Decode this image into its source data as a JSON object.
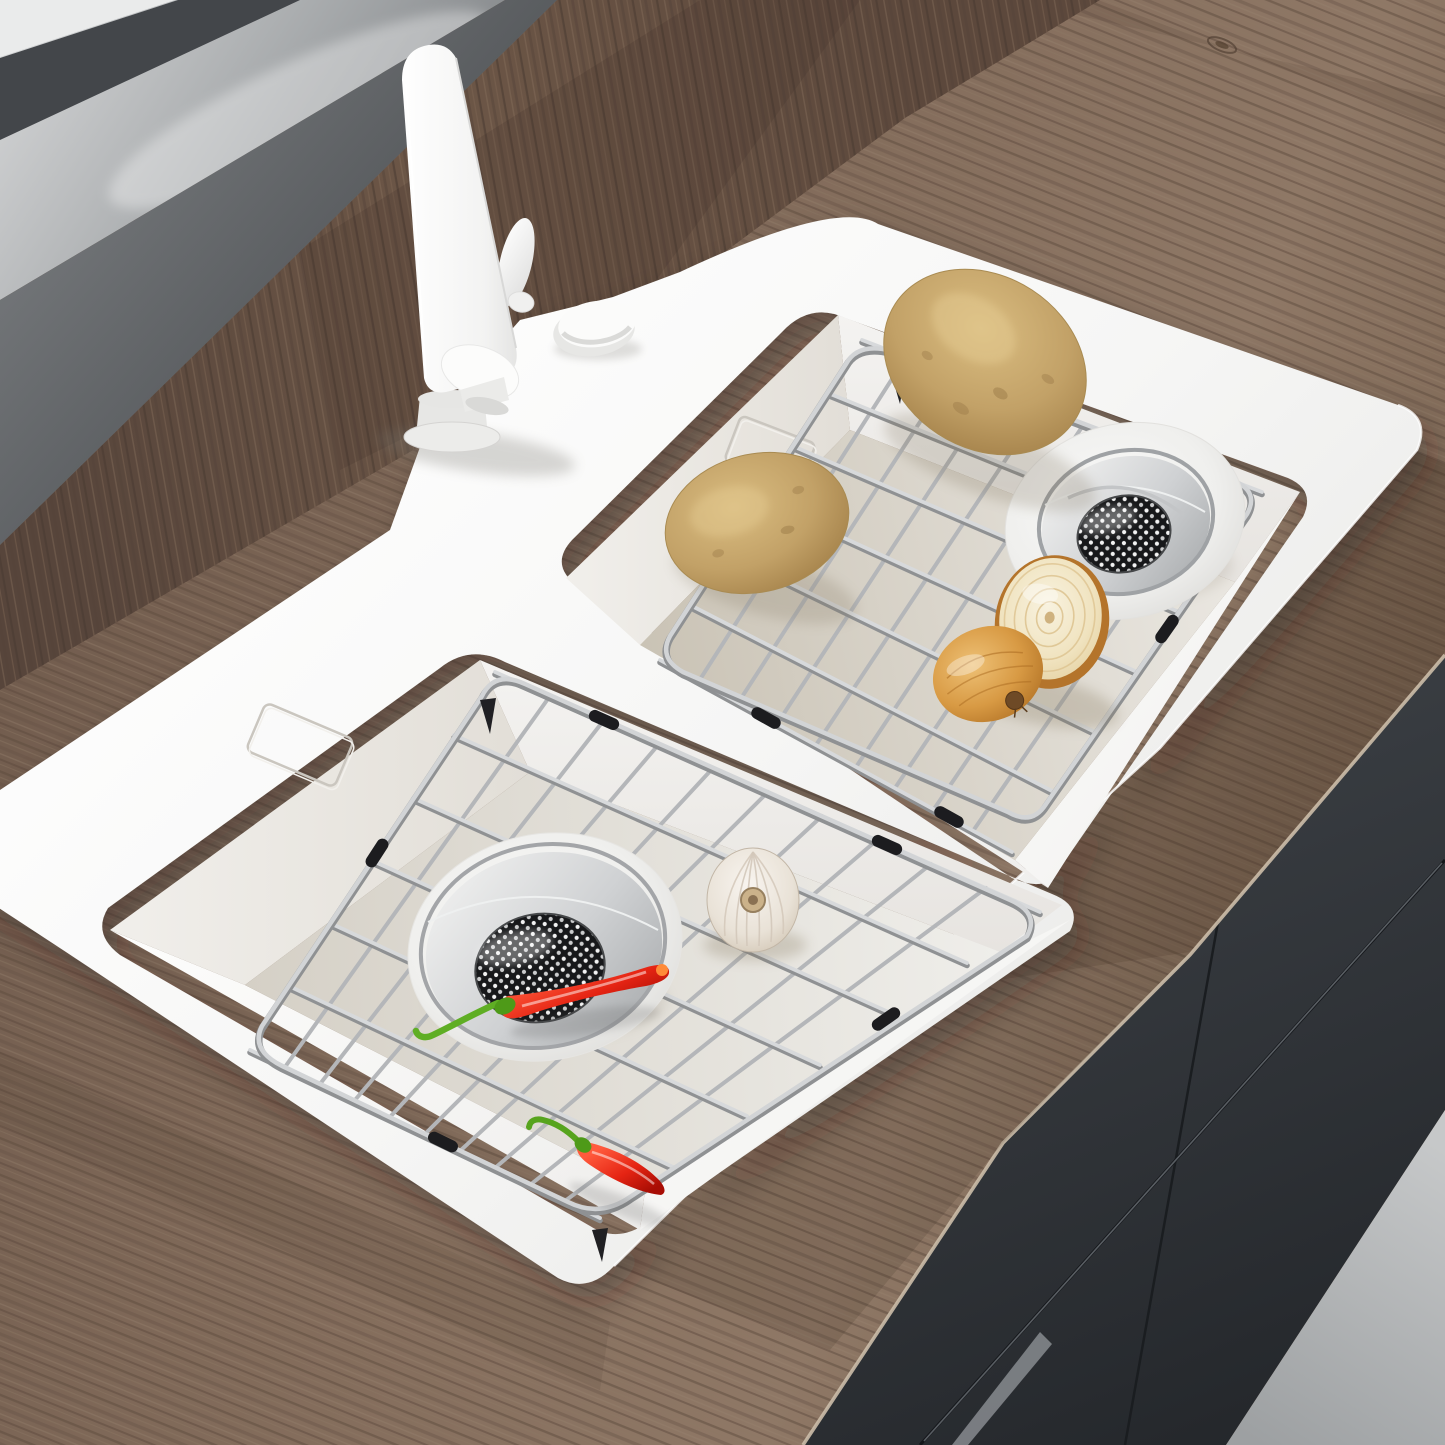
{
  "meta": {
    "type": "product-photo",
    "subject": "White double-bowl drop-in kitchen sink with stainless-steel bottom grids and drain strainers",
    "setting": "Walnut wood countertop with charcoal cabinet fronts and a gray window sill"
  },
  "alt": "Top-down angled view of a glossy white double-basin kitchen sink set into a walnut countertop. A tall white modern faucet and a round soap-dispenser cap sit on the deck. Each basin holds a stainless wire bottom grid with black bumpers and a round strainer drain. Two potatoes and two onion halves lie in the upper basin; a garlic bulb and two red chili peppers lie in the lower basin. Dark charcoal cabinets and a gray floor show at the lower right.",
  "palette": {
    "wood_counter": "#7d675a",
    "wood_backsplash": "#624e42",
    "cabinet_charcoal": "#2f3338",
    "floor_gray": "#b4b6b8",
    "sill_gray": "#9a9da0",
    "sink_white": "#f6f6f5",
    "basin_floor_greige": "#d8d2c6",
    "steel_wire": "#c0c2c4",
    "bumper_black": "#1c1c1f",
    "mesh_black": "#17181a",
    "potato_tan": "#c2a167",
    "onion_skin": "#d89a44",
    "onion_flesh": "#f3ecd6",
    "garlic_white": "#efe9e0",
    "chili_red": "#e02413",
    "chili_green": "#57a41d"
  },
  "objects": {
    "faucet": "white single-handle tall faucet",
    "soap_dispenser": "white round soap dispenser cap",
    "sink_deck": "white sink rim and divider",
    "upper_basin": "right basin with grid, drain, potatoes and onion halves",
    "lower_basin": "left basin with grid, drain, garlic and chili peppers",
    "grid": "stainless wire bottom grid with rubber bumpers",
    "drain": "round strainer drain with perforated mesh basket",
    "countertop": "walnut wood countertop",
    "backsplash": "walnut wood backsplash strip",
    "window_sill": "glossy gray sill with dark frame",
    "cabinets": "charcoal handleless cabinet fronts",
    "floor": "light gray floor"
  }
}
